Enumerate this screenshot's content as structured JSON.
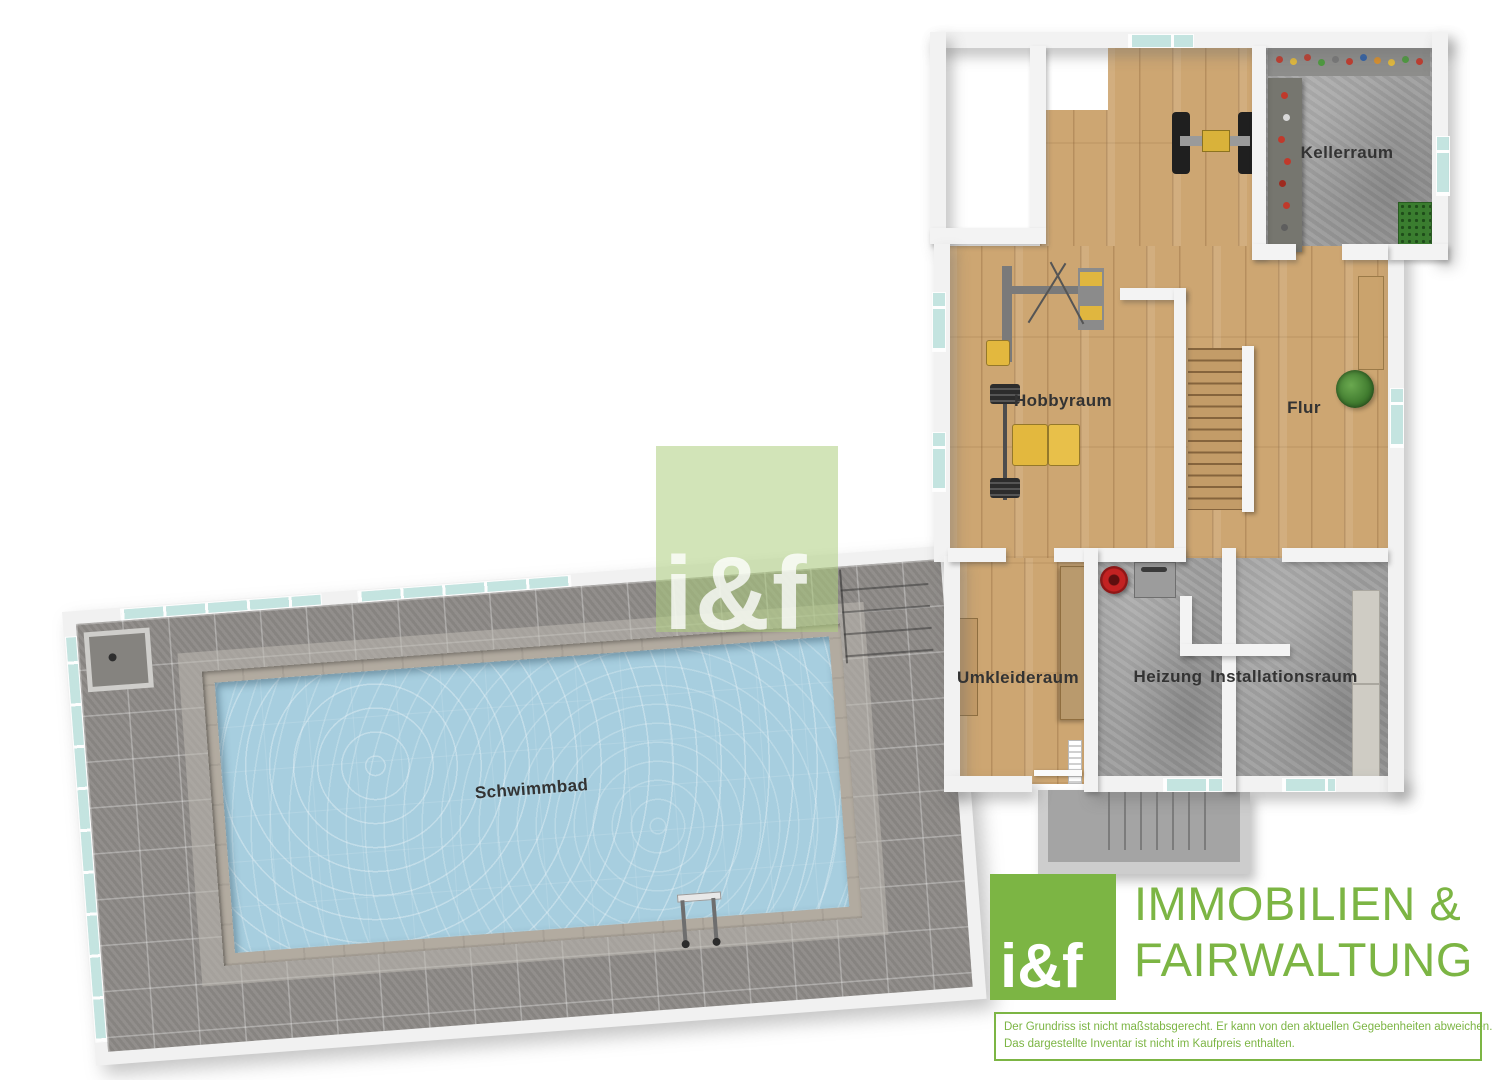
{
  "plan": {
    "rooms": {
      "kellerraum": {
        "label": "Kellerraum",
        "floor": "concrete"
      },
      "hobbyraum": {
        "label": "Hobbyraum",
        "floor": "wood"
      },
      "flur": {
        "label": "Flur",
        "floor": "wood"
      },
      "umkleideraum": {
        "label": "Umkleideraum",
        "floor": "wood"
      },
      "heizung": {
        "label": "Heizung",
        "floor": "concrete"
      },
      "installationsraum": {
        "label": "Installationsraum",
        "floor": "concrete"
      },
      "schwimmbad": {
        "label": "Schwimmbad",
        "floor": "water"
      }
    },
    "watermark": {
      "text": "i&f"
    }
  },
  "branding": {
    "logo_text": "i&f",
    "company_line1": "IMMOBILIEN &",
    "company_line2": "FAIRWALTUNG",
    "disclaimer_line1": "Der Grundriss ist nicht maßstabsgerecht. Er kann von den aktuellen Gegebenheiten abweichen.",
    "disclaimer_line2": "Das dargestellte Inventar ist nicht im Kaufpreis enthalten."
  },
  "colors": {
    "brand_green": "#7cb544",
    "watermark_green": "rgba(173,205,125,0.55)",
    "pool_water": "#a7cedf",
    "deck_tile": "#8e8b88",
    "wood_floor": "#cda672",
    "concrete_floor": "#9f9f9f",
    "wall": "#f3f3f3",
    "glass": "#bfe2de"
  }
}
